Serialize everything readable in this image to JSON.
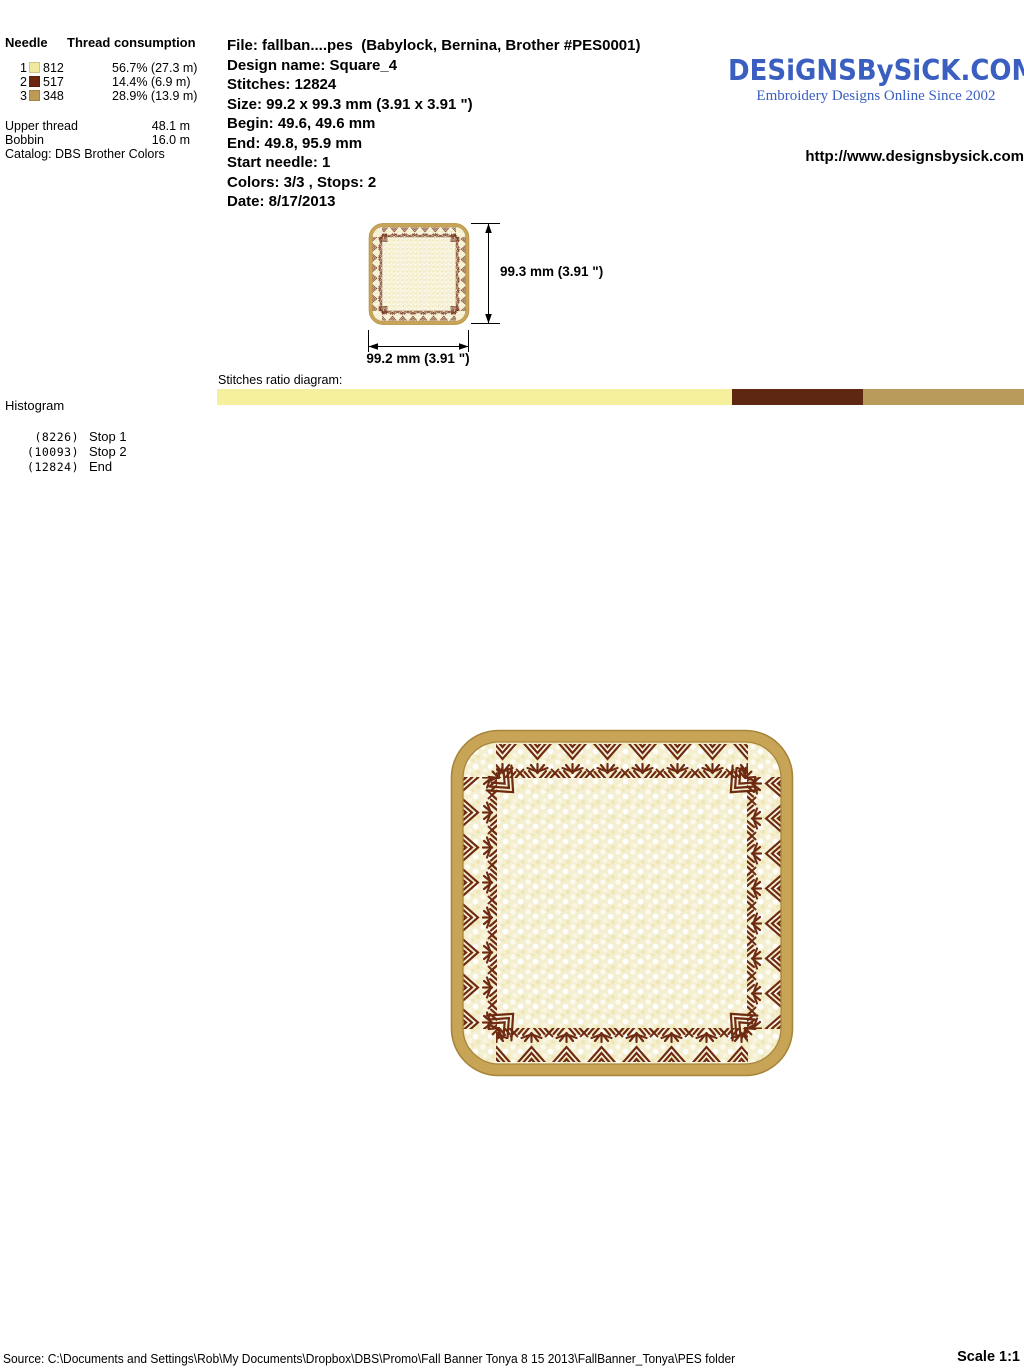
{
  "needle_table": {
    "header_needle": "Needle",
    "header_consumption": "Thread consumption",
    "rows": [
      {
        "needle": "1",
        "color": "#F1E99E",
        "thread": "812",
        "consumption": "56.7% (27.3 m)"
      },
      {
        "needle": "2",
        "color": "#6B2710",
        "thread": "517",
        "consumption": "14.4% (6.9 m)"
      },
      {
        "needle": "3",
        "color": "#BF9A55",
        "thread": "348",
        "consumption": "28.9% (13.9 m)"
      }
    ],
    "upper_thread_label": "Upper thread",
    "upper_thread_value": "48.1 m",
    "bobbin_label": "Bobbin",
    "bobbin_value": "16.0 m",
    "catalog": "Catalog: DBS Brother Colors"
  },
  "file_info": {
    "lines": [
      "File: fallban....pes  (Babylock, Bernina, Brother #PES0001)",
      "Design name: Square_4",
      "Stitches: 12824",
      "Size: 99.2 x 99.3 mm (3.91 x 3.91 \")",
      "Begin: 49.6, 49.6 mm",
      "End: 49.8, 95.9 mm",
      "Start needle: 1",
      "Colors: 3/3 , Stops: 2",
      "Date: 8/17/2013"
    ]
  },
  "branding": {
    "logo_text": "DESiGNSBySiCK.COM",
    "tagline": "Embroidery Designs Online Since 2002",
    "url": "http://www.designsbysick.com",
    "logo_color": "#3A5FC0"
  },
  "dimensions": {
    "height_label": "99.3 mm (3.91 \")",
    "width_label": "99.2 mm (3.91 \")"
  },
  "ratio": {
    "label": "Stitches ratio diagram:",
    "segments": [
      {
        "color": "#F6EF9C",
        "percent": 56.7
      },
      {
        "color": "#5E2712",
        "percent": 14.4
      },
      {
        "color": "#B99B5B",
        "percent": 28.9
      }
    ]
  },
  "histogram": {
    "label": "Histogram",
    "stops": [
      {
        "count": "(8226)",
        "label": "Stop 1"
      },
      {
        "count": "(10093)",
        "label": "Stop 2"
      },
      {
        "count": "(12824)",
        "label": "End"
      }
    ]
  },
  "design": {
    "border_color": "#C8A456",
    "border_edge_color": "#A8853C",
    "fill_color": "#F5EFD2",
    "pattern_color": "#6E2B12"
  },
  "chart_data": {
    "type": "bar",
    "title": "Stitches ratio diagram",
    "categories": [
      "Thread 812",
      "Thread 517",
      "Thread 348"
    ],
    "values": [
      56.7,
      14.4,
      28.9
    ],
    "colors": [
      "#F6EF9C",
      "#5E2712",
      "#B99B5B"
    ],
    "annotations": [
      "(8226) Stop 1",
      "(10093) Stop 2",
      "(12824) End"
    ]
  },
  "footer": {
    "source": "Source: C:\\Documents and Settings\\Rob\\My Documents\\Dropbox\\DBS\\Promo\\Fall Banner Tonya 8 15 2013\\FallBanner_Tonya\\PES folder",
    "scale": "Scale 1:1"
  }
}
